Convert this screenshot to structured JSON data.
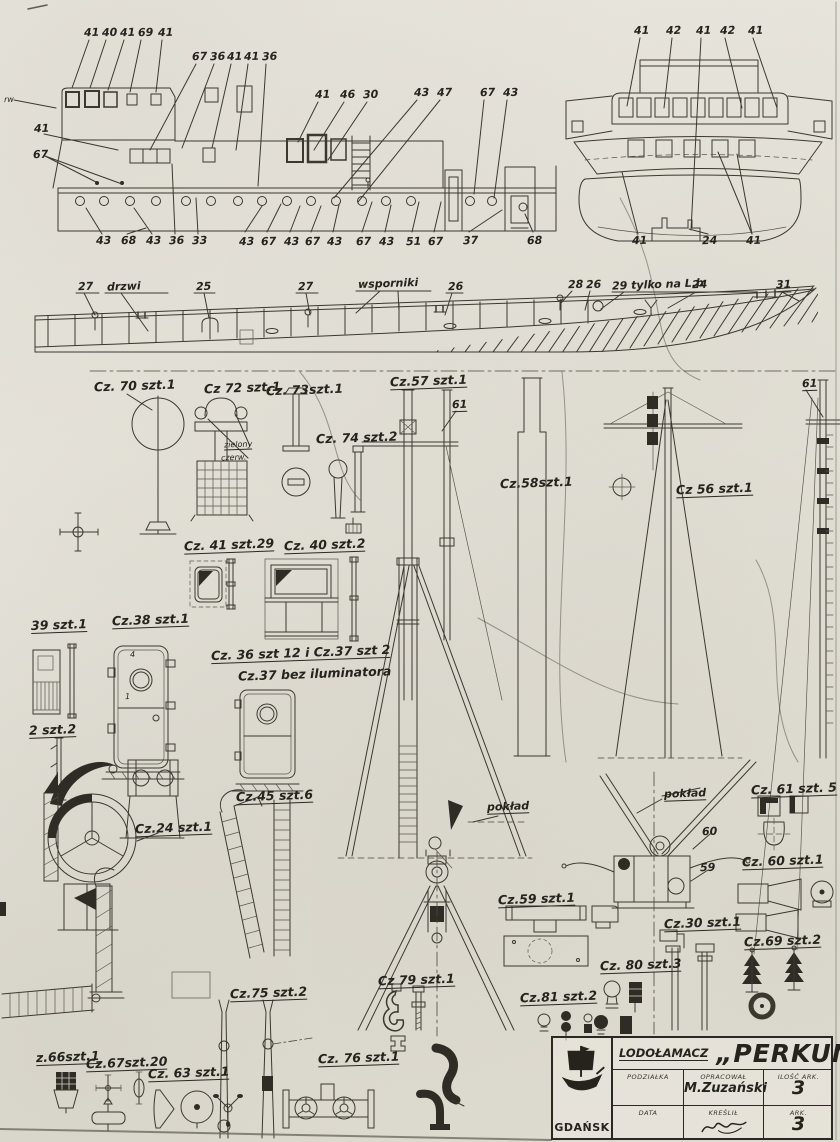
{
  "callouts": {
    "side_top": [
      "41",
      "40",
      "41",
      "69",
      "41",
      "67",
      "36",
      "41",
      "41",
      "36",
      "41",
      "46",
      "30",
      "43",
      "47",
      "67",
      "43",
      "rw",
      "41",
      "67"
    ],
    "side_bottom": [
      "43",
      "68",
      "43",
      "36",
      "33",
      "43",
      "67",
      "43",
      "67",
      "43",
      "67",
      "43",
      "51",
      "67",
      "37",
      "68"
    ],
    "front_top": [
      "41",
      "42",
      "41",
      "42",
      "41"
    ],
    "front_bottom": [
      "41",
      "24",
      "41"
    ]
  },
  "profile": [
    "27",
    "drzwi",
    "25",
    "27",
    "wsporniki",
    "26",
    "28",
    "26",
    "29 tylko na L.b",
    "24",
    "31"
  ],
  "parts": [
    "Cz. 70 szt.1",
    "Cz 72 szt.1",
    "Cz. 73szt.1",
    "Cz. 74 szt.2",
    "Cz.57 szt.1",
    "61",
    "Cz.58szt.1",
    "Cz 56 szt.1",
    "61",
    "Cz. 41 szt.29",
    "Cz. 40 szt.2",
    "39 szt.1",
    "Cz.38 szt.1",
    "Cz. 36 szt 12 i Cz.37 szt 2",
    "Cz.37 bez iluminatora",
    "2 szt.2",
    "Cz.24 szt.1",
    "Cz.45 szt.6",
    "pokład",
    "pokład",
    "Cz. 61 szt. 5",
    "60",
    "59",
    "Cz. 60 szt.1",
    "Cz.59 szt.1",
    "Cz.30 szt.1",
    "Cz.69 szt.2",
    "Cz. 80 szt.3",
    "Cz.81 szt.2",
    "Cz 79 szt.1",
    "Cz.75 szt.2",
    "Cz. 76 szt.1",
    "z.66szt.1",
    "Cz.67szt.20",
    "Cz. 63 szt.1",
    "zielony",
    "czerw.",
    "4",
    "1"
  ],
  "title_block": {
    "type": "LODOŁAMACZ",
    "name": "„PERKUN”",
    "city": "GDAŃSK",
    "scale_label": "PODZIAŁKA",
    "prepared_label": "OPRACOWAŁ",
    "prepared_by": "M.Zuzański",
    "count_label": "ILOŚĆ ARK.",
    "count_value": "3",
    "date_label": "DATA",
    "drawn_label": "KREŚLIŁ",
    "sheet_label": "ARK.",
    "sheet_value": "3"
  },
  "colors": {
    "paper": "#e6e3da",
    "ink": "#3b3830",
    "dark_fill": "#2f2c26"
  }
}
